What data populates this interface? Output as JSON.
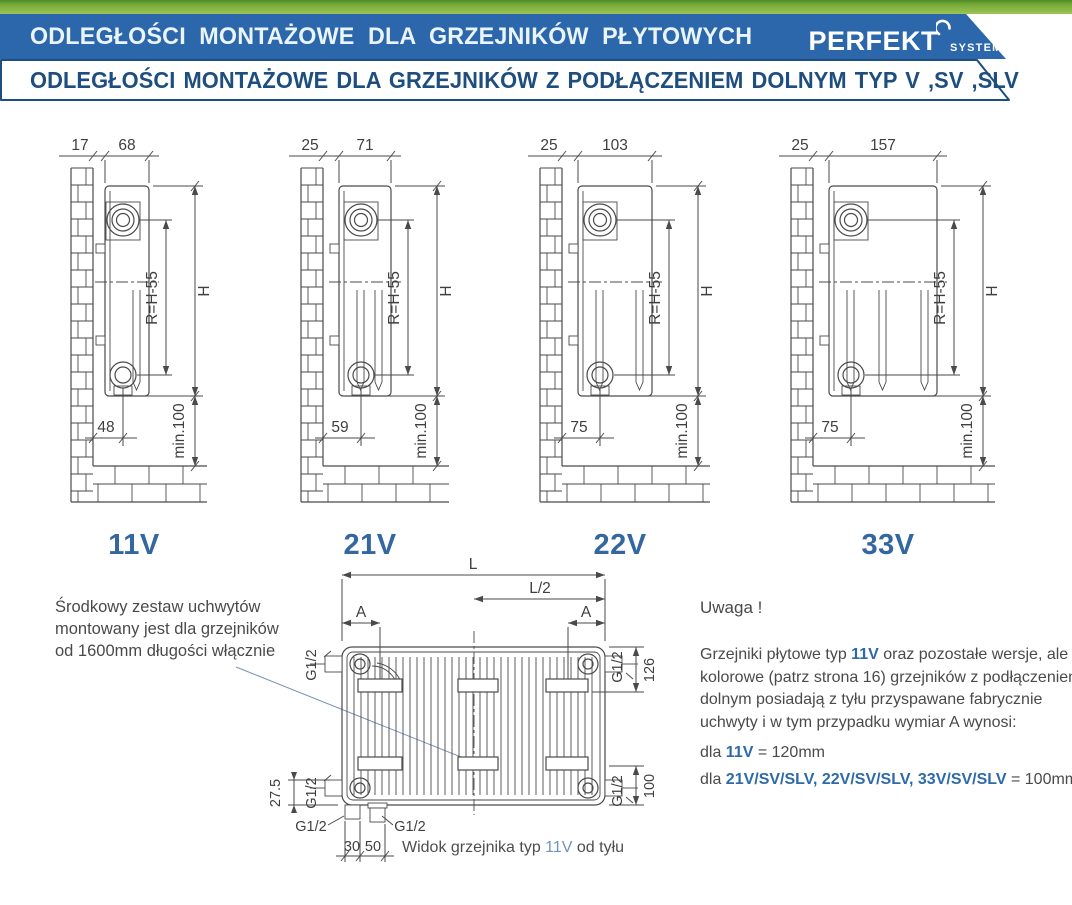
{
  "header": {
    "bar1": "ODLEGŁOŚCI MONTAŻOWE DLA GRZEJNIKÓW PŁYTOWYCH",
    "brand": "PERFEKT",
    "brand_sub": "SYSTEM",
    "bar2": "ODLEGŁOŚCI MONTAŻOWE DLA GRZEJNIKÓW Z PODŁĄCZENIEM DOLNYM TYP V ,SV ,SLV"
  },
  "colors": {
    "green": "#7fae3c",
    "banner_blue": "#2b67aa",
    "navy": "#1d4e7f",
    "type_label_blue": "#33679f",
    "note_blue": "#2e6aa8",
    "caption_blue": "#6e94bd",
    "line_gray": "#4a4a4a"
  },
  "diagrams_shared": {
    "inner_height": "R=H-55",
    "height": "H",
    "min_clearance": "min.100"
  },
  "diagrams": [
    {
      "type_label": "11V",
      "wall_offset": "17",
      "depth": "68",
      "bottom_offset": "48",
      "panels": 1,
      "rad_w": 44,
      "gap": 12
    },
    {
      "type_label": "21V",
      "wall_offset": "25",
      "depth": "71",
      "bottom_offset": "59",
      "panels": 2,
      "rad_w": 52,
      "gap": 16
    },
    {
      "type_label": "22V",
      "wall_offset": "25",
      "depth": "103",
      "bottom_offset": "75",
      "panels": 2,
      "rad_w": 74,
      "gap": 16
    },
    {
      "type_label": "33V",
      "wall_offset": "25",
      "depth": "157",
      "bottom_offset": "75",
      "panels": 3,
      "rad_w": 108,
      "gap": 16
    }
  ],
  "rear_view": {
    "dim_l": "L",
    "dim_l_half": "L/2",
    "dim_a": "A",
    "g12": "G1/2",
    "dim_126": "126",
    "dim_100": "100",
    "dim_27_5": "27.5",
    "dim_30": "30",
    "dim_50": "50",
    "caption": [
      {
        "t": "Widok grzejnika typ "
      },
      {
        "t": "11V",
        "b": true
      },
      {
        "t": " od tyłu"
      }
    ]
  },
  "note_left": {
    "lines": [
      "Środkowy zestaw uchwytów",
      "montowany jest dla grzejników",
      "od 1600mm długości włącznie"
    ]
  },
  "note_right": {
    "title": "Uwaga !",
    "para": [
      {
        "t": "Grzejniki płytowe typ "
      },
      {
        "t": "11V",
        "b": true
      },
      {
        "t": " oraz pozostałe wersje, ale kolorowe (patrz strona 16) grzejników z podłączeniem dolnym posiadają z tyłu przyspawane fabrycznie uchwyty i w tym przypadku wymiar A wynosi:"
      }
    ],
    "rule1": [
      {
        "t": "dla "
      },
      {
        "t": "11V",
        "b": true
      },
      {
        "t": " = 120mm"
      }
    ],
    "rule2": [
      {
        "t": "dla "
      },
      {
        "t": "21V/SV/SLV, 22V/SV/SLV, 33V/SV/SLV",
        "b": true
      },
      {
        "t": " = 100mm"
      }
    ]
  }
}
